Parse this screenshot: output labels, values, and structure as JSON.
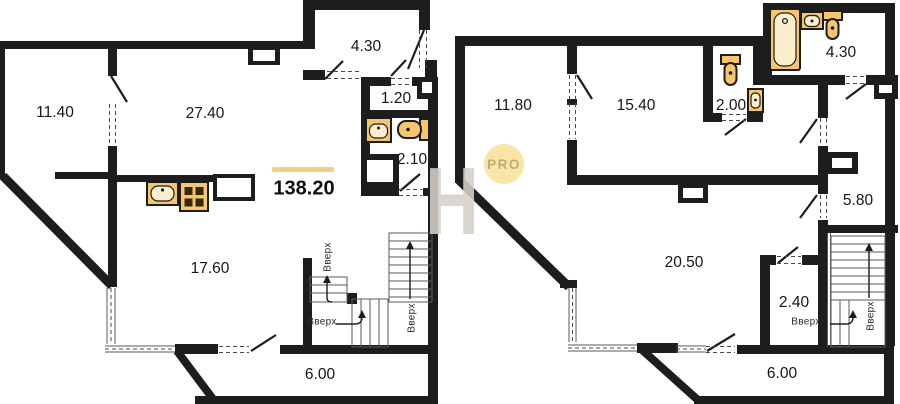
{
  "badge": {
    "text": "PRO"
  },
  "watermark": {
    "letter": "H"
  },
  "floor1": {
    "total_area": "138.20",
    "rooms": {
      "room_a": "11.40",
      "room_b": "27.40",
      "balcony_top": "4.30",
      "hallway": "1.20",
      "bathroom": "2.10",
      "kitchen": "17.60",
      "balcony_bottom": "6.00"
    },
    "stairs": {
      "up1": "Вверх",
      "up2": "Вверх",
      "up3": "Вверх"
    }
  },
  "floor2": {
    "rooms": {
      "room_a": "11.80",
      "room_b": "15.40",
      "wc": "2.00",
      "bathroom": "4.30",
      "corridor": "5.80",
      "living": "20.50",
      "storage": "2.40",
      "balcony": "6.00"
    },
    "stairs": {
      "up1": "Вверх",
      "up2": "Вверх"
    }
  },
  "colors": {
    "wall": "#1d1d1d",
    "fixture_fill": "#f6c56d",
    "fixture_light": "#fdeecd",
    "area_highlight": "#f0d087",
    "badge_bg": "#f9e6a6",
    "badge_text": "#bfab72",
    "watermark": "#d6d0c8"
  }
}
